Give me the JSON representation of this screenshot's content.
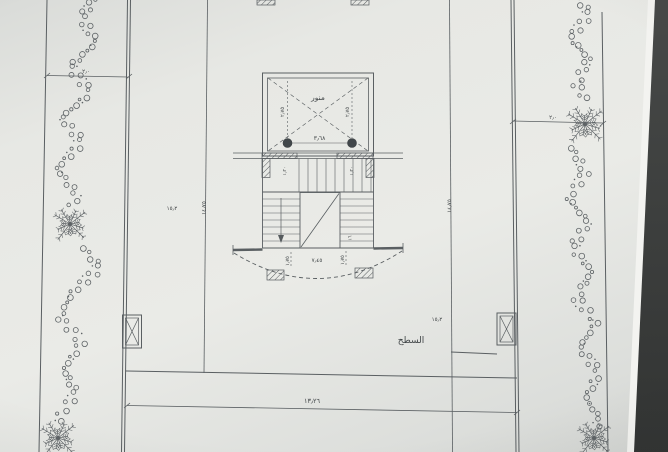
{
  "colors": {
    "photo_background": "#3e403e",
    "paper": "#e8e9e5",
    "paper_edge_highlight": "#f3f3f0",
    "drawing_ink": "#5a5f62",
    "text_ink": "#3f4446"
  },
  "plan": {
    "room_label": "السطح",
    "lightwell_label": "منور",
    "dims": {
      "lightwell_width": "٣٫٦٨",
      "lightwell_depth_left": "٢٫٧٥",
      "lightwell_depth_right": "٢٫٧٥",
      "stair_flight_left": "١٫٢٠",
      "stair_flight_right": "١٫٢٠",
      "stair_risers": "١٦",
      "balcony_side_left": "١٫٧٥",
      "balcony_side_right": "١٫٧٥",
      "balcony_total": "٧٫٤٥",
      "height_left": "١٤٫٧٥",
      "height_right": "١٤٫٧٥",
      "width_bottom": "١٣٫٢٦",
      "setback_left": "٢٫٠",
      "setback_right": "٢٫٠",
      "level_left": "١٥٫٢",
      "level_right": "١٥٫٢"
    }
  }
}
